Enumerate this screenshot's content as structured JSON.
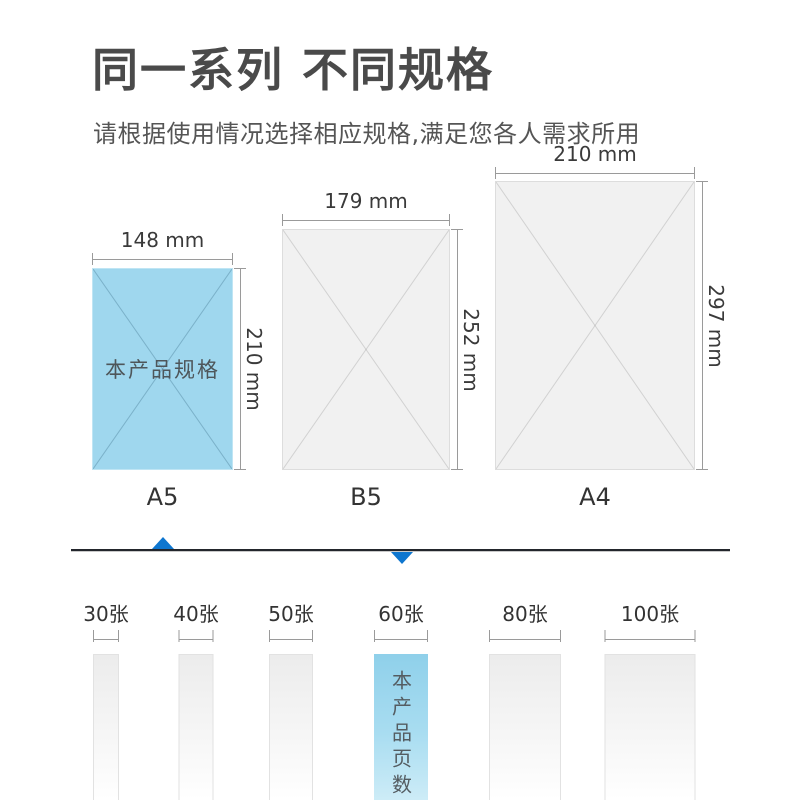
{
  "header": {
    "title": "同一系列 不同规格",
    "subtitle": "请根据使用情况选择相应规格,满足您各人需求所用"
  },
  "papers": [
    {
      "name": "A5",
      "width_label": "148 mm",
      "height_label": "210 mm",
      "note": "本产品规格",
      "width_mm": 148,
      "height_mm": 210,
      "highlighted": true
    },
    {
      "name": "B5",
      "width_label": "179 mm",
      "height_label": "252 mm",
      "width_mm": 179,
      "height_mm": 252,
      "highlighted": false
    },
    {
      "name": "A4",
      "width_label": "210 mm",
      "height_label": "297 mm",
      "width_mm": 210,
      "height_mm": 297,
      "highlighted": false
    }
  ],
  "page_counts": {
    "items": [
      {
        "label": "30张",
        "highlighted": false
      },
      {
        "label": "40张",
        "highlighted": false
      },
      {
        "label": "50张",
        "highlighted": false
      },
      {
        "label": "60张",
        "note": "本产品页数",
        "highlighted": true
      },
      {
        "label": "80张",
        "highlighted": false
      },
      {
        "label": "100张",
        "highlighted": false
      }
    ]
  },
  "colors": {
    "highlight_blue": "#9fd7ee",
    "bar_blue_top": "#8fd0ea",
    "arrow_blue": "#0e76cf",
    "divider_dark": "#23262c",
    "neutral_fill": "#f1f1f1",
    "dim_line_gray": "#9a9a9a",
    "title_gray": "#4a4a4a"
  }
}
